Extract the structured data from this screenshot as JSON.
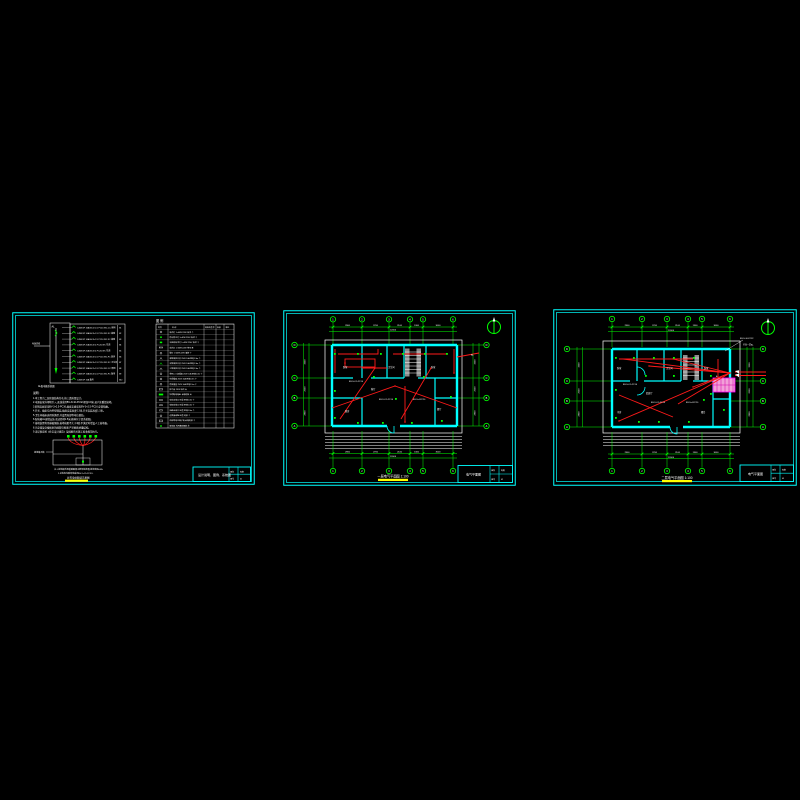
{
  "colors": {
    "background": "#000000",
    "border": "#00ffff",
    "dimension": "#00ff00",
    "wiring": "#ff1a1a",
    "text": "#ffffff",
    "highlight": "#ffff00",
    "equipment_fill": "#f2a0d8",
    "equipment_line": "#ff00ff",
    "stair_gray": "#8c8c8c"
  },
  "sheet1": {
    "system": {
      "incoming": "电源进线",
      "panel": "AL",
      "panel_caption": "AL配电箱系统图",
      "rows": [
        "C45N/1P 16A BV-2×2.5 PC16 WC.CC 照明",
        "C45N/1P 16A BV-3×2.5 PC16 WC.FC 插座",
        "C45N/1P 16A BV-3×2.5 PC16 WC.FC 插座",
        "C45N/1P 20A BV-3×4 PC20 WC 空调",
        "C45N/1P 20A BV-3×4 PC20 WC 空调",
        "C45N/1P 16A BV-3×2.5 PC16 WC.FC 厨房",
        "C45N/1P 16A BV-3×2.5 PC16 WC.FC 卫生间",
        "C45N/1P 16A BV-2×2.5 PC16 WC.CC 照明",
        "C45N/1P 16A BV-3×2.5 PC16 WC.FC 备用",
        "C45N/1P 16A 备用"
      ],
      "tags": [
        "N1",
        "N2",
        "N3",
        "N4",
        "N5",
        "N6",
        "N7",
        "N8",
        "N9",
        "N10"
      ]
    },
    "legend": {
      "title": "图 例",
      "header": [
        "符号",
        "名 称",
        "规格及型号",
        "安装",
        "单位"
      ],
      "rows": [
        "吸顶灯 1×40W 220V 吸顶 个",
        "防水防尘灯 1×40W 220V 吸顶 个",
        "半圆球吸顶灯 1×40W 220V 吸顶 个",
        "荧光灯 1×36W 220V 链吊 套",
        "壁灯 1×40W 220V 墙装 个",
        "单联单控开关 250V 10A 距地1.3m 个",
        "双联单控开关 250V 10A 距地1.3m 个",
        "三联单控开关 250V 10A 距地1.3m 个",
        "单相二三极插座 250V 10A 距地0.3m 个",
        "空调插座 250V 16A 距地1.8m 个",
        "防溅插座 250V 10A 距地1.5m 个",
        "排气扇 220V 吸顶 台",
        "照明配电箱AL 嵌墙暗装 台",
        "电话出线口 86型 距地0.3m 个",
        "电视出线口 86型 距地0.3m 个",
        "网络出线口 86型 距地0.3m 个",
        "过路接线盒 86型 暗装 个",
        "局部等电位端子箱 嵌墙暗装 个",
        "接地极 利用基础钢筋 处"
      ]
    },
    "notes": {
      "title": "说明:",
      "lines": [
        "1.本工程为二层砖混结构住宅,按三类防雷设计。",
        "2.电源由室外埋地引入,进线采用BV-3×10-PC32,埋深0.8米,进户处重复接地。",
        "3.照明支线采用BV-2×2.5-PC16,插座支线采用BV-3×2.5-PC16,穿管暗敷。",
        "4.开关、插座均为86型暗装,插座安装高度0.3米,开关安装高度1.3米。",
        "5.卫生间插座选用防溅型,并设置局部等电位联结。",
        "6.配电箱AL嵌墙安装,底边距地1.5米,箱体尺寸见系统图。",
        "7.接地装置利用基础钢筋,接地电阻不大于4欧,不满足时增设人工接地极。",
        "8.凡穿墙及穿楼板处的线管均预埋,严禁剔凿承重结构。",
        "9.未尽事宜按《住宅设计规范》及国家有关施工验收规范执行。"
      ]
    },
    "ground": {
      "side_label": "接地端子箱",
      "caption1": "注:1.接地极利用基础圈梁主筋焊接连通,接地电阻≤4Ω。",
      "caption2": "2.总等电位联结线采用BV-1×25-PC32。",
      "label": "总等电位联结示意图"
    },
    "title_block": {
      "title": "设计说明、图例、系统图",
      "labels": [
        "图别",
        "图号"
      ],
      "values": [
        "电施",
        "01"
      ]
    }
  },
  "sheet2": {
    "axis_top": [
      "1",
      "2",
      "3",
      "4",
      "5",
      "6"
    ],
    "axis_left": [
      "D",
      "C",
      "B",
      "A"
    ],
    "axis_right": [
      "D",
      "C",
      "B",
      "A"
    ],
    "dims_top": [
      "2900",
      "2700",
      "2100",
      "1300",
      "3000"
    ],
    "dims_top_total": "12000",
    "dims_bottom": [
      "2900",
      "2700",
      "2100",
      "1300",
      "3000"
    ],
    "dims_bottom_total": "12000",
    "dims_left": [
      "3300",
      "2000",
      "2800"
    ],
    "dims_right": [
      "3300",
      "2000",
      "2800"
    ],
    "rooms": [
      "卧室",
      "客厅",
      "卫生间",
      "卧室",
      "厨房",
      "餐厅"
    ],
    "wires": [
      "BV-2×2.5-PC16",
      "BV-3×2.5-PC16",
      "BV-3×4-PC20"
    ],
    "callout": "AL",
    "title": "一层电气平面图 1:100",
    "title_block": {
      "title": "电气平面图",
      "labels": [
        "图别",
        "图号"
      ],
      "values": [
        "电施",
        "02"
      ]
    }
  },
  "sheet3": {
    "axis_top": [
      "1",
      "2",
      "3",
      "4",
      "5",
      "6"
    ],
    "axis_left": [
      "D",
      "C",
      "B",
      "A"
    ],
    "axis_right": [
      "D",
      "C",
      "B",
      "A"
    ],
    "dims_top": [
      "2900",
      "2700",
      "2100",
      "1300",
      "3000"
    ],
    "dims_top_total": "12000",
    "dims_bottom": [
      "2900",
      "2700",
      "2100",
      "1300",
      "3000"
    ],
    "dims_bottom_total": "12000",
    "dims_left": [
      "3300",
      "2000",
      "2800"
    ],
    "dims_right": [
      "3300",
      "2000",
      "2800"
    ],
    "rooms": [
      "卧室",
      "起居厅",
      "卫生间",
      "卧室",
      "书房",
      "露台"
    ],
    "wires": [
      "BV-2×2.5-PC16",
      "BV-3×2.5-PC16",
      "BV-3×4-PC20"
    ],
    "callouts": [
      "BV-3×10-PC32",
      "引自一层AL"
    ],
    "equip": "AL",
    "title": "二层电气平面图 1:100",
    "title_block": {
      "title": "电气平面图",
      "labels": [
        "图别",
        "图号"
      ],
      "values": [
        "电施",
        "03"
      ]
    }
  }
}
